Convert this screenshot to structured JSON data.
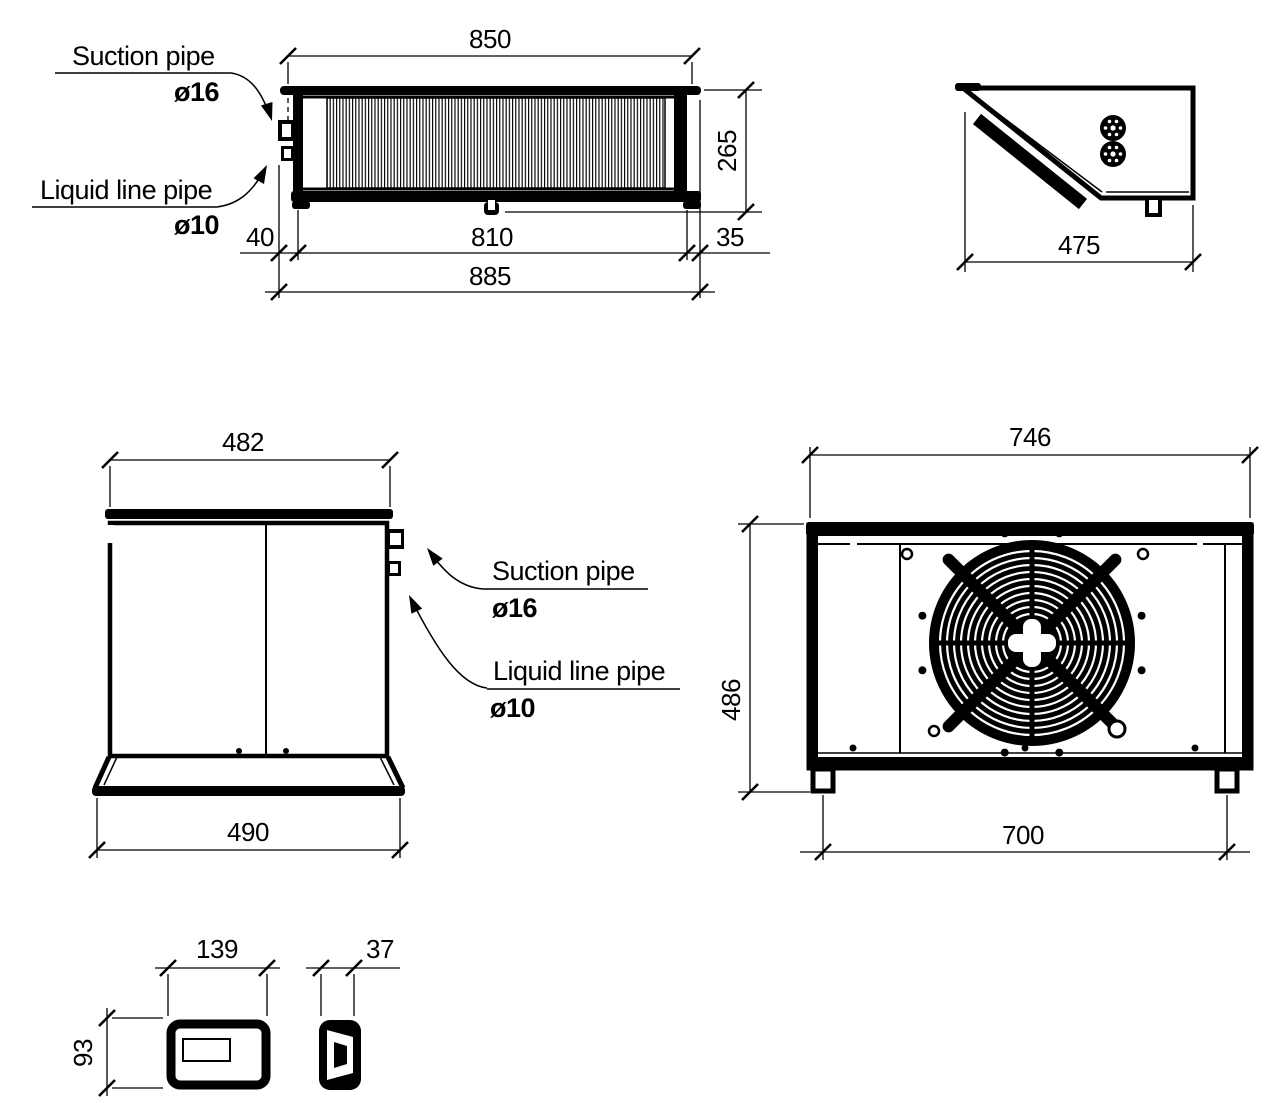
{
  "top_view": {
    "dim_850": "850",
    "dim_265": "265",
    "dim_40": "40",
    "dim_810": "810",
    "dim_35": "35",
    "dim_885": "885",
    "suction_label": "Suction pipe",
    "suction_dia": "ø16",
    "liquid_label": "Liquid line pipe",
    "liquid_dia": "ø10"
  },
  "side_profile": {
    "dim_475": "475"
  },
  "side_view": {
    "dim_482": "482",
    "dim_490": "490",
    "suction_label": "Suction pipe",
    "suction_dia": "ø16",
    "liquid_label": "Liquid line pipe",
    "liquid_dia": "ø10"
  },
  "fan_view": {
    "dim_746": "746",
    "dim_486": "486",
    "dim_700": "700"
  },
  "controller": {
    "dim_139": "139",
    "dim_37": "37",
    "dim_93": "93"
  },
  "colors": {
    "line": "#000000",
    "background": "#ffffff"
  }
}
